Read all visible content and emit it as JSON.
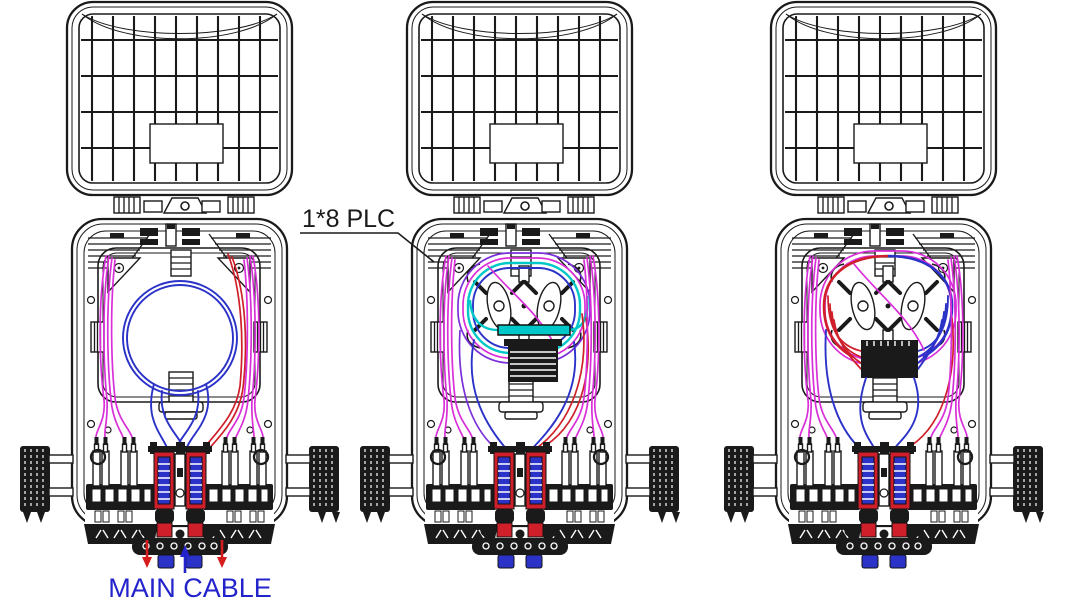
{
  "diagram": {
    "annotations": {
      "plc_label": "1*8 PLC",
      "main_cable_label": "MAIN CABLE"
    },
    "colors": {
      "outline": "#1a1a1a",
      "fiber_magenta": "#d92fd9",
      "fiber_blue": "#2b32c8",
      "fiber_red": "#cf1f2a",
      "plc_splitter_cyan": "#00c8c8",
      "fiber_purple": "#7a2fd9",
      "label_blue": "#2323cc",
      "arrow_red": "#d61c1c"
    }
  }
}
